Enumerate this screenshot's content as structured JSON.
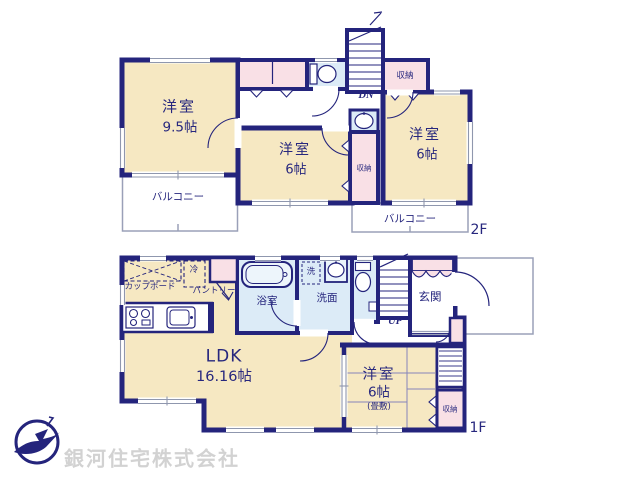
{
  "floors": {
    "f2": {
      "tag": "2F",
      "room_left": {
        "name": "洋室",
        "size": "9.5帖"
      },
      "room_center": {
        "name": "洋室",
        "size": "6帖"
      },
      "room_right": {
        "name": "洋室",
        "size": "6帖"
      },
      "balcony_left": "バルコニー",
      "balcony_right": "バルコニー",
      "closet_top": "収納",
      "closet_mid": "収納",
      "stairs_label": "DN"
    },
    "f1": {
      "tag": "1F",
      "ldk": {
        "name": "LDK",
        "size": "16.16帖"
      },
      "room": {
        "name": "洋室",
        "size": "6帖",
        "note": "(畳敷)"
      },
      "bath": "浴室",
      "washroom": "洗面",
      "washer": "洗",
      "cupboard": "カップボード",
      "fridge": "冷",
      "pantry": "パントリー",
      "entrance": "玄関",
      "closet": "収納",
      "stairs_label": "UP"
    }
  },
  "watermark": "銀河住宅株式会社",
  "colors": {
    "wall": "#24247c",
    "room_fill": "#f6e8c2",
    "closet_fill": "#f9e0e6",
    "wet_fill": "#dcebf7",
    "text": "#27277e",
    "watermark": "#d2d2d2"
  }
}
